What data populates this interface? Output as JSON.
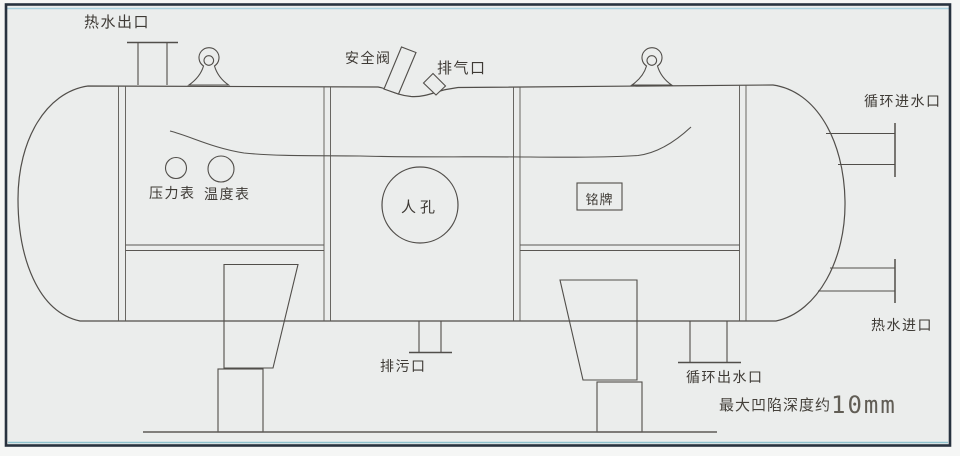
{
  "diagram": {
    "title_hint": "horizontal-hot-water-pressure-vessel-drawing",
    "labels": {
      "hot_water_outlet": "热水出口",
      "safety_valve": "安全阀",
      "vent_port": "排气口",
      "circulation_inlet": "循环进水口",
      "pressure_gauge": "压力表",
      "temperature_gauge": "温度表",
      "manhole": "人孔",
      "nameplate": "铭牌",
      "drain_port": "排污口",
      "circulation_outlet": "循环出水口",
      "hot_water_inlet": "热水进口",
      "dent_note_prefix": "最大凹陷深度约",
      "dent_note_value": "10mm"
    },
    "colors": {
      "paper": "#ebedec",
      "outer_margin": "#f5f6f5",
      "line": "#514e4a",
      "seam_line": "#5a5753",
      "frame_border": "#28323f",
      "frame_accent_cyan": "#a8d2e0",
      "label_text": "#3e3a35"
    }
  }
}
